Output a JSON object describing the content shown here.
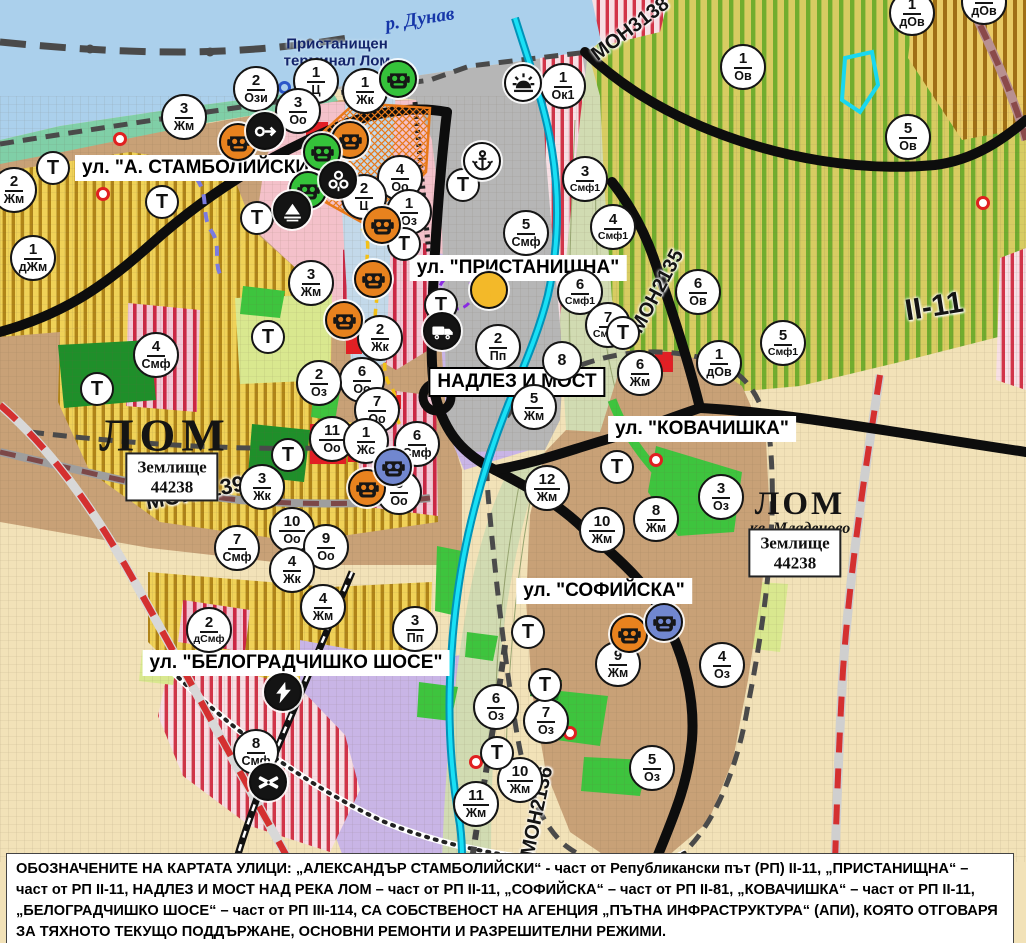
{
  "map": {
    "river_label": {
      "text": "р. Дунав",
      "x": 420,
      "y": 20,
      "color": "#1636a8"
    },
    "terminal_label": {
      "text": "Пристанищен\nтерминал Лом",
      "x": 337,
      "y": 53,
      "color": "#13246b"
    },
    "street_labels": [
      {
        "text": "ул. \"А. СТАМБОЛИЙСКИ\"",
        "x": 200,
        "y": 168,
        "boxed": false
      },
      {
        "text": "ул. \"ПРИСТАНИЩНА\"",
        "x": 518,
        "y": 268,
        "boxed": false
      },
      {
        "text": "НАДЛЕЗ И МОСТ",
        "x": 517,
        "y": 382,
        "boxed": true
      },
      {
        "text": "ул. \"КОВАЧИШКА\"",
        "x": 702,
        "y": 429,
        "boxed": false
      },
      {
        "text": "ул. \"СОФИЙСКА\"",
        "x": 604,
        "y": 591,
        "boxed": false
      },
      {
        "text": "ул. \"БЕЛОГРАДЧИШКО ШОСЕ\"",
        "x": 296,
        "y": 663,
        "boxed": false
      }
    ],
    "area_labels": [
      {
        "text": "ЛОМ",
        "x": 165,
        "y": 436,
        "size": 46,
        "serif": true,
        "bold": true,
        "ls": 6
      },
      {
        "text": "ЛОМ",
        "x": 800,
        "y": 504,
        "size": 33,
        "serif": true,
        "bold": true,
        "ls": 3
      },
      {
        "text": "кв. Младеново",
        "x": 800,
        "y": 529,
        "size": 16,
        "serif": true,
        "bold": true,
        "italic": true,
        "ls": 0
      }
    ],
    "zemlishte_boxes": [
      {
        "text": "Землище\n44238",
        "x": 172,
        "y": 477
      },
      {
        "text": "Землище\n44238",
        "x": 795,
        "y": 553
      }
    ],
    "road_labels": [
      {
        "text": "МОН3139",
        "x": 145,
        "y": 480,
        "rot": -11,
        "size": 22
      },
      {
        "text": "МОН3138",
        "x": 585,
        "y": 18,
        "rot": -37,
        "size": 20
      },
      {
        "text": "МОН2135",
        "x": 612,
        "y": 280,
        "rot": -62,
        "size": 20
      },
      {
        "text": "МОН2136",
        "x": 492,
        "y": 800,
        "rot": -78,
        "size": 20
      },
      {
        "text": "II-11",
        "x": 905,
        "y": 290,
        "rot": -9,
        "size": 30
      }
    ],
    "t_label": "Т",
    "zone_markers": [
      {
        "n": "2",
        "c": "Ози",
        "x": 256,
        "y": 89
      },
      {
        "n": "1",
        "c": "Ц",
        "x": 316,
        "y": 81
      },
      {
        "n": "3",
        "c": "Оо",
        "x": 298,
        "y": 111
      },
      {
        "n": "1",
        "c": "Жк",
        "x": 365,
        "y": 91
      },
      {
        "n": "3",
        "c": "Жм",
        "x": 184,
        "y": 117
      },
      {
        "n": "2",
        "c": "Жм",
        "x": 14,
        "y": 190
      },
      {
        "n": "1",
        "c": "дЖм",
        "x": 33,
        "y": 258
      },
      {
        "n": "4",
        "c": "Оо",
        "x": 400,
        "y": 178
      },
      {
        "n": "2",
        "c": "Ц",
        "x": 364,
        "y": 197
      },
      {
        "n": "1",
        "c": "Оз",
        "x": 409,
        "y": 212
      },
      {
        "n": "5",
        "c": "Смф",
        "x": 526,
        "y": 233
      },
      {
        "n": "3",
        "c": "Смф1",
        "x": 585,
        "y": 179
      },
      {
        "n": "1",
        "c": "Ок1",
        "x": 563,
        "y": 86
      },
      {
        "n": "1",
        "c": "Ов",
        "x": 743,
        "y": 67
      },
      {
        "n": "1",
        "c": "дОв",
        "x": 912,
        "y": 13
      },
      {
        "n": "1",
        "c": "дОв",
        "x": 984,
        "y": 2
      },
      {
        "n": "5",
        "c": "Ов",
        "x": 908,
        "y": 137
      },
      {
        "n": "4",
        "c": "Смф1",
        "x": 613,
        "y": 227
      },
      {
        "n": "6",
        "c": "Ов",
        "x": 698,
        "y": 292
      },
      {
        "n": "6",
        "c": "Смф1",
        "x": 580,
        "y": 292
      },
      {
        "n": "7",
        "c": "Смф1",
        "x": 608,
        "y": 325
      },
      {
        "n": "5",
        "c": "Смф1",
        "x": 783,
        "y": 343
      },
      {
        "n": "1",
        "c": "дОв",
        "x": 719,
        "y": 363
      },
      {
        "n": "3",
        "c": "Жм",
        "x": 311,
        "y": 283
      },
      {
        "n": "2",
        "c": "Жк",
        "x": 380,
        "y": 338
      },
      {
        "n": "6",
        "c": "Оо",
        "x": 362,
        "y": 380
      },
      {
        "n": "2",
        "c": "Оз",
        "x": 319,
        "y": 383
      },
      {
        "n": "7",
        "c": "Оо",
        "x": 377,
        "y": 410
      },
      {
        "n": "11",
        "c": "Оо",
        "x": 332,
        "y": 439
      },
      {
        "n": "1",
        "c": "Жс",
        "x": 366,
        "y": 441
      },
      {
        "n": "6",
        "c": "Смф",
        "x": 417,
        "y": 444
      },
      {
        "n": "8",
        "c": "Оо",
        "x": 399,
        "y": 492
      },
      {
        "n": "3",
        "c": "Жк",
        "x": 262,
        "y": 487
      },
      {
        "n": "10",
        "c": "Оо",
        "x": 292,
        "y": 530
      },
      {
        "n": "9",
        "c": "Оо",
        "x": 326,
        "y": 547
      },
      {
        "n": "7",
        "c": "Смф",
        "x": 237,
        "y": 548
      },
      {
        "n": "4",
        "c": "Жк",
        "x": 292,
        "y": 570
      },
      {
        "n": "4",
        "c": "Смф",
        "x": 156,
        "y": 355
      },
      {
        "n": "2",
        "c": "Пп",
        "x": 498,
        "y": 347
      },
      {
        "n": "8",
        "c": "",
        "x": 565,
        "y": 364
      },
      {
        "n": "5",
        "c": "Жм",
        "x": 534,
        "y": 407
      },
      {
        "n": "6",
        "c": "Жм",
        "x": 640,
        "y": 373
      },
      {
        "n": "12",
        "c": "Жм",
        "x": 547,
        "y": 488
      },
      {
        "n": "10",
        "c": "Жм",
        "x": 602,
        "y": 530
      },
      {
        "n": "8",
        "c": "Жм",
        "x": 656,
        "y": 519
      },
      {
        "n": "3",
        "c": "Оз",
        "x": 721,
        "y": 497
      },
      {
        "n": "9",
        "c": "Жм",
        "x": 618,
        "y": 664
      },
      {
        "n": "4",
        "c": "Оз",
        "x": 722,
        "y": 665
      },
      {
        "n": "6",
        "c": "Оз",
        "x": 496,
        "y": 707
      },
      {
        "n": "7",
        "c": "Оз",
        "x": 546,
        "y": 721
      },
      {
        "n": "5",
        "c": "Оз",
        "x": 652,
        "y": 768
      },
      {
        "n": "10",
        "c": "Жм",
        "x": 520,
        "y": 780
      },
      {
        "n": "11",
        "c": "Жм",
        "x": 476,
        "y": 804
      },
      {
        "n": "4",
        "c": "Жм",
        "x": 323,
        "y": 607
      },
      {
        "n": "3",
        "c": "Пп",
        "x": 415,
        "y": 629
      },
      {
        "n": "2",
        "c": "дСмф",
        "x": 209,
        "y": 630
      },
      {
        "n": "8",
        "c": "Смф",
        "x": 256,
        "y": 752
      }
    ],
    "t_markers": [
      {
        "x": 53,
        "y": 168
      },
      {
        "x": 162,
        "y": 202
      },
      {
        "x": 257,
        "y": 218
      },
      {
        "x": 268,
        "y": 337
      },
      {
        "x": 97,
        "y": 389
      },
      {
        "x": 288,
        "y": 455
      },
      {
        "x": 404,
        "y": 244
      },
      {
        "x": 441,
        "y": 305
      },
      {
        "x": 463,
        "y": 185
      },
      {
        "x": 623,
        "y": 333
      },
      {
        "x": 617,
        "y": 467
      },
      {
        "x": 528,
        "y": 632
      },
      {
        "x": 545,
        "y": 685
      },
      {
        "x": 497,
        "y": 753
      }
    ],
    "poi_markers": [
      {
        "icon": "mask",
        "bg": "#e8821e",
        "x": 238,
        "y": 142
      },
      {
        "icon": "mask",
        "bg": "#e8821e",
        "x": 350,
        "y": 140
      },
      {
        "icon": "mask",
        "bg": "#e8821e",
        "x": 382,
        "y": 225
      },
      {
        "icon": "mask",
        "bg": "#e8821e",
        "x": 373,
        "y": 279
      },
      {
        "icon": "mask",
        "bg": "#e8821e",
        "x": 344,
        "y": 320
      },
      {
        "icon": "mask",
        "bg": "#e8821e",
        "x": 367,
        "y": 488
      },
      {
        "icon": "mask",
        "bg": "#e8821e",
        "x": 629,
        "y": 634
      },
      {
        "icon": "mask",
        "bg": "#35c23a",
        "x": 398,
        "y": 79
      },
      {
        "icon": "mask",
        "bg": "#35c23a",
        "x": 322,
        "y": 152
      },
      {
        "icon": "mask",
        "bg": "#35c23a",
        "x": 308,
        "y": 190
      },
      {
        "icon": "mask",
        "bg": "#7187cf",
        "x": 393,
        "y": 467
      },
      {
        "icon": "mask",
        "bg": "#7187cf",
        "x": 664,
        "y": 622
      },
      {
        "icon": "arrow",
        "bg": "#141414",
        "x": 265,
        "y": 131
      },
      {
        "icon": "clover",
        "bg": "#141414",
        "x": 338,
        "y": 180
      },
      {
        "icon": "tunnel",
        "bg": "#141414",
        "x": 292,
        "y": 210
      },
      {
        "icon": "anchor",
        "bg": "#ffffff",
        "x": 482,
        "y": 161
      },
      {
        "icon": "sun",
        "bg": "#ffffff",
        "x": 523,
        "y": 83
      },
      {
        "icon": "truck",
        "bg": "#141414",
        "x": 442,
        "y": 331
      },
      {
        "icon": "exclamation",
        "bg": "#f3b929",
        "x": 489,
        "y": 290,
        "glyph": "!"
      },
      {
        "icon": "lightning",
        "bg": "#141414",
        "x": 283,
        "y": 692
      },
      {
        "icon": "rail-crossing",
        "bg": "#141414",
        "x": 268,
        "y": 782
      }
    ],
    "red_dots": [
      {
        "x": 120,
        "y": 139
      },
      {
        "x": 103,
        "y": 194
      },
      {
        "x": 656,
        "y": 460
      },
      {
        "x": 570,
        "y": 733
      },
      {
        "x": 476,
        "y": 762
      },
      {
        "x": 983,
        "y": 203
      }
    ],
    "blue_rings": [
      {
        "x": 284,
        "y": 87
      }
    ],
    "footer_note": "ОБОЗНАЧЕНИТЕ НА КАРТАТА УЛИЦИ: „АЛЕКСАНДЪР СТАМБОЛИЙСКИ“ - част от Републикански път (РП) II-11, „ПРИСТАНИЩНА“ – част от РП II-11, НАДЛЕЗ И МОСТ НАД РЕКА ЛОМ – част от РП II-11, „СОФИЙСКА“ – част от РП II-81, „КОВАЧИШКА“ – част от РП II-11, „БЕЛОГРАДЧИШКО ШОСЕ“ – част от РП III-114, СА СОБСТВЕНОСТ НА АГЕНЦИЯ „ПЪТНА ИНФРАСТРУКТУРА“ (АПИ), КОЯТО ОТГОВАРЯ ЗА ТЯХНОТО ТЕКУЩО ПОДДЪРЖАНЕ, ОСНОВНИ РЕМОНТИ И РАЗРЕШИТЕЛНИ РЕЖИМИ.",
    "palette": {
      "water": "#abd0ec",
      "port": "#b6b6b6",
      "residential_tan": "#c8a177",
      "vineyard_yellow": "#f0d258",
      "orchard_green": "#71ad2e",
      "mixed_red_stripe": "#d23448",
      "industry_purple": "#c9b5e6",
      "park_green": "#3ec43e",
      "dark_green": "#1f8f2a",
      "fields_cream": "#f2e2b8",
      "river_lom_cyan": "#19e0f5",
      "poi_orange": "#e8821e",
      "poi_blue": "#7187cf",
      "road_black": "#0d0d0d",
      "road_red_dash": "#d43030"
    }
  }
}
